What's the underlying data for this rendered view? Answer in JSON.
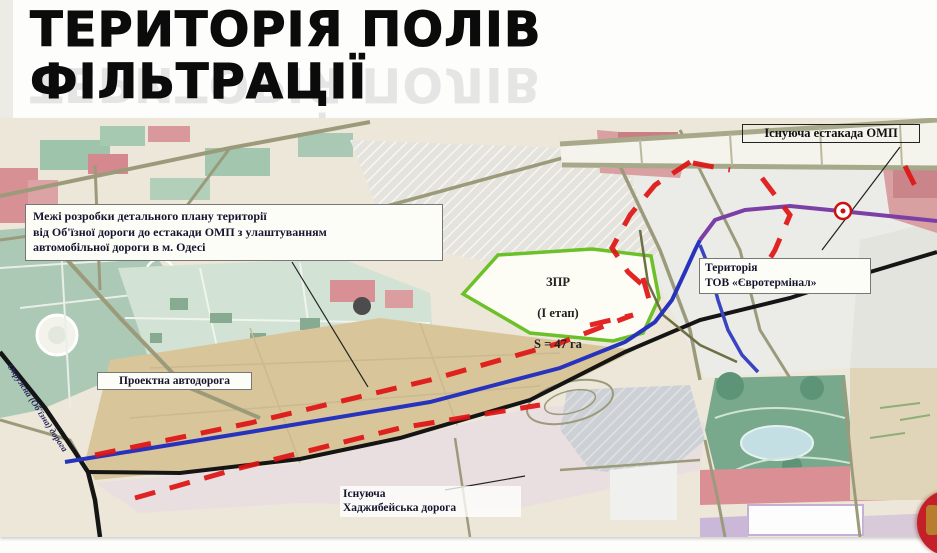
{
  "slide": {
    "title_line1": "ТЕРИТОРІЯ ПОЛІВ",
    "title_line2": "ФІЛЬТРАЦІЇ"
  },
  "map": {
    "labels": {
      "boundary_note": "Межі розробки детального плану території\nвід Об'їзної дороги до естакади ОМП з улаштуванням\nавтомобільної дороги в м. Одесі",
      "existing_overpass": "Існуюча естакада ОМП",
      "zpr_title": "ЗПР",
      "zpr_stage": "(І етап)",
      "zpr_area": "S = 47 га",
      "euroterminal": "Територія\nТОВ «Євротермінал»",
      "project_road": "Проектна автодорога",
      "khadzhibey_road": "Існуюча\nХаджибейська дорога",
      "ring_road": "Окружна (Об'їзна) дорога"
    },
    "legend_colors": {
      "development_boundary_dashed": "#df1414",
      "project_road_line": "#2733bd",
      "existing_overpass_line": "#7b3fa5",
      "zpr_site_outline": "#6cc028",
      "existing_road": "#151515"
    }
  }
}
